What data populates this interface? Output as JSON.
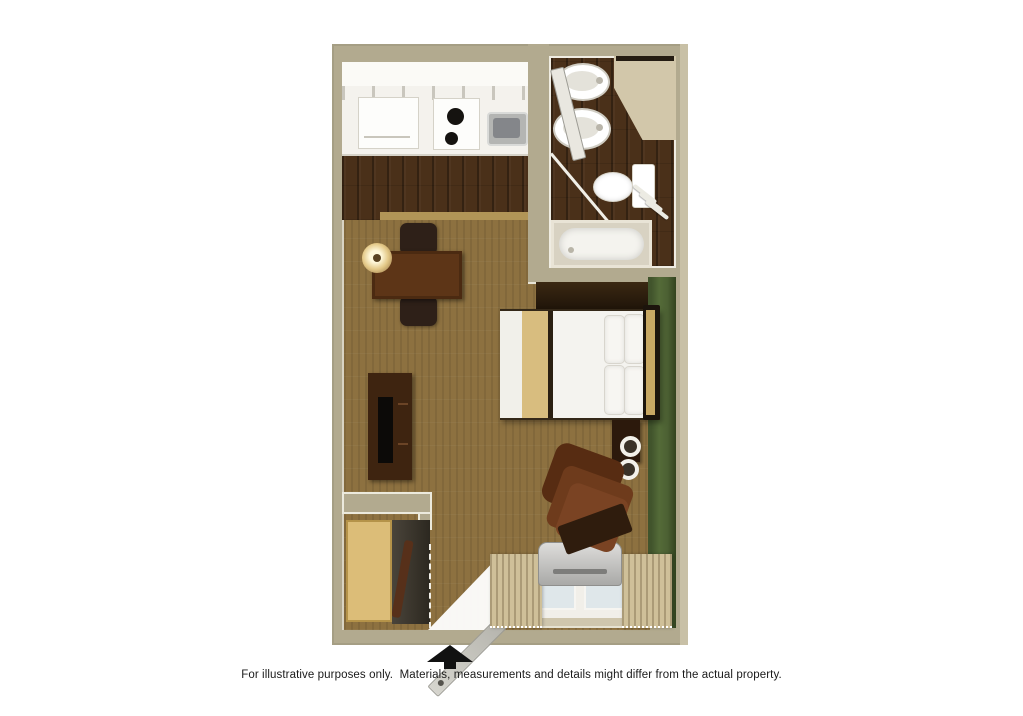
{
  "caption": {
    "text": "For illustrative purposes only.  Materials, measurements and details might differ from the actual property."
  },
  "colors": {
    "wall_beige": "#b2aa8f",
    "wall_beige_light": "#c8c0a6",
    "green_accent": "#4c6033",
    "carpet": "#8d7140",
    "wood_dark": "#4a3019",
    "dark_furn": "#42260f",
    "closet_wood": "#dcbd78",
    "bed_white": "#f4f3ef",
    "bed_tan": "#d8bd7f",
    "chair_brown": "#6e3b1c",
    "fixture_white": "#f7f6f2",
    "ac_gray": "#b7b7b5",
    "arrow_black": "#111111",
    "caption_color": "#1a1a1a"
  },
  "floor_plan": {
    "type": "studio-suite-top-down-3d-render",
    "rooms": [
      "kitchen",
      "bathroom",
      "sleeping-living-area",
      "entry-closet-alcove"
    ],
    "fixtures": [
      "refrigerator",
      "stove-two-burners",
      "kitchen-sink",
      "bathroom-sink",
      "bathroom-sink-2",
      "toilet",
      "bathtub",
      "shower-rod",
      "vanity-counter",
      "mirror"
    ],
    "furniture": [
      "queen-bed",
      "nightstand",
      "dining-table",
      "dining-chair",
      "dining-chair-2",
      "wall-sconce",
      "tv-stand",
      "television",
      "armchair-recliner",
      "ottoman",
      "closet",
      "ironing-board"
    ],
    "openings": [
      "entry-door-open",
      "bathroom-door-open",
      "window-with-curtains"
    ],
    "equipment": [
      "ptac-ac-heater-unit"
    ],
    "symbols": [
      "entrance-arrow"
    ]
  }
}
